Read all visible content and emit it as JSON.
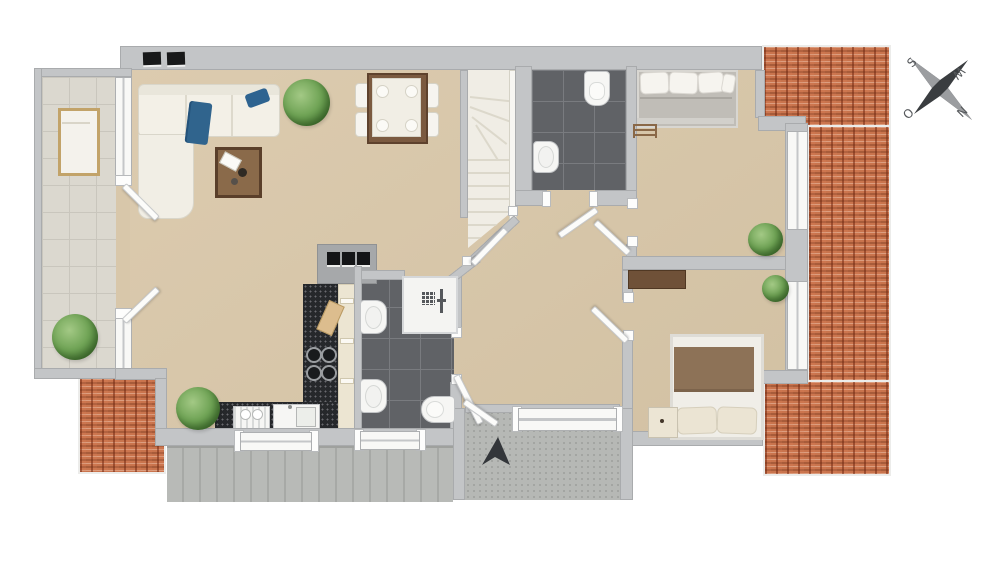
{
  "scene": {
    "type": "apartment-floor-plan-3d-top-view"
  },
  "compass": {
    "top_left": "S",
    "top_right": "W",
    "bottom_left": "O",
    "bottom_right": "N"
  },
  "palette": {
    "background": "#ffffff",
    "floor": "#d8c7aa",
    "wall": "#c3c5c7",
    "roof": "#c9744d",
    "bath_tile": "#606266",
    "balcony_tile": "#dbd8cf",
    "terrace": "#b6b8b5",
    "stairs": "#f0ede5",
    "counter": "#26282b",
    "wood": "#7b5a3e",
    "textile_blue": "#2e6390",
    "blanket_brown": "#8d7257",
    "plant_green": "#6fa355"
  },
  "rooms": {
    "living_dining": [
      "sofa",
      "chaise",
      "coffee-table",
      "potted-plant",
      "dining-table",
      "dining-chairs",
      "plates"
    ],
    "kitchen": [
      "counter",
      "cooktop",
      "cutting-board",
      "sink",
      "dishwasher",
      "cabinets",
      "vent-block"
    ],
    "bathroom_main": [
      "shower",
      "washbasin",
      "washbasin",
      "toilet"
    ],
    "wc_top": [
      "toilet",
      "washbasin"
    ],
    "bedroom_top": [
      "double-bed",
      "pillows",
      "radiator",
      "plant"
    ],
    "bedroom_bottom": [
      "double-bed",
      "pillows",
      "nightstand",
      "sideboard",
      "plant"
    ],
    "outdoor": [
      "balcony",
      "lounger",
      "balcony-plant",
      "terrace",
      "entrance-arrow",
      "roof-tiles",
      "skylights"
    ],
    "circulation": [
      "winder-staircase",
      "hallway",
      "doors"
    ]
  }
}
